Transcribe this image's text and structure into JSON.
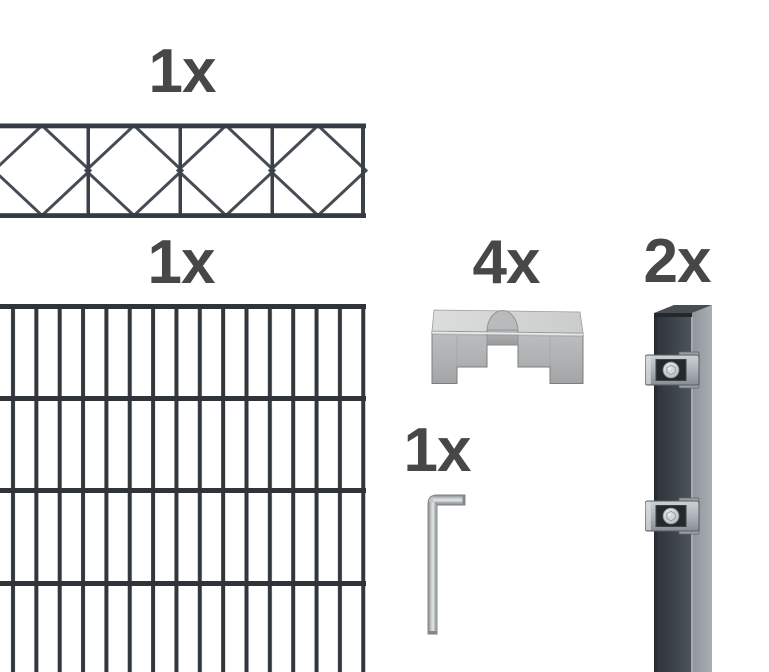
{
  "product_kit": {
    "decorative_panel": {
      "quantity": "1x"
    },
    "mesh_panel": {
      "quantity": "1x"
    },
    "cover_clamp": {
      "quantity": "4x"
    },
    "post": {
      "quantity": "2x"
    },
    "allen_key": {
      "quantity": "1x"
    }
  },
  "colors": {
    "background": "#ffffff",
    "label_text": "#474747",
    "fence_wire_dark": "#30373d",
    "fence_wire_mid": "#454c53",
    "post_front_dark": "#2c3238",
    "post_front_light": "#4e555b",
    "post_side_gray": "#9ba1a7",
    "steel_light": "#d8dadb",
    "steel_mid": "#b0b3b5",
    "steel_dark": "#8a8e91"
  }
}
